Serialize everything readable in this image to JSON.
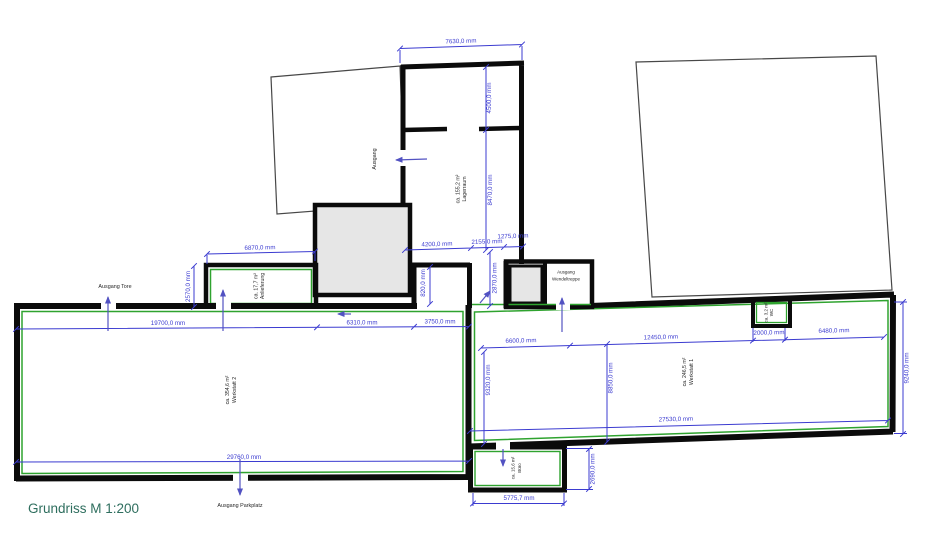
{
  "title": "Grundriss M 1:200",
  "rooms": {
    "lagerraum": {
      "name": "Lagerraum",
      "area": "ca. 155,2 m²"
    },
    "anlieferung": {
      "name": "Anlieferung",
      "area": "ca. 17,7 m²"
    },
    "werkstatt2": {
      "name": "Werkstatt 2",
      "area": "ca. 354,6 m²"
    },
    "werkstatt1": {
      "name": "Werkstatt 1",
      "area": "ca. 246,5 m²"
    },
    "wc": {
      "name": "WC",
      "area": "ca. 3,2 m²"
    },
    "buero": {
      "name": "Büro",
      "area": "ca. 15,6 m²"
    }
  },
  "exits": {
    "ausgang": "Ausgang",
    "tore": "Ausgang Tore",
    "wendeltreppe_line1": "Ausgang",
    "wendeltreppe_line2": "Wendeltreppe",
    "parkplatz": "Ausgang Parkplatz"
  },
  "dims": {
    "d7630": "7630,0 mm",
    "d4500": "4500,0 mm",
    "d8470": "8470,0 mm",
    "d4200": "4200,0 mm",
    "d2155": "2155,0 mm",
    "d1275": "1275,0 mm",
    "d2870": "2870,0 mm",
    "d820": "820,0 mm",
    "d6870": "6870,0 mm",
    "d2570": "2570,0 mm",
    "d19700": "19700,0 mm",
    "d6310": "6310,0 mm",
    "d3750": "3750,0 mm",
    "d6600": "6600,0 mm",
    "d12450": "12450,0 mm",
    "d2000": "2000,0 mm",
    "d6480": "6480,0 mm",
    "d9320": "9320,0 mm",
    "d8850": "8850,0 mm",
    "d9240": "9240,0 mm",
    "d27530": "27530,0 mm",
    "d29760": "29760,0 mm",
    "d2690": "2690,0 mm",
    "d5775": "5775,7 mm"
  },
  "colors": {
    "wall": "#0b0b0b",
    "new_wall_green": "#2fa32f",
    "dimension_blue": "#3b3bd0",
    "arrow_blue": "#5252c2",
    "gray_fill": "#e6e6e6",
    "title_color": "#2e6e5e"
  }
}
